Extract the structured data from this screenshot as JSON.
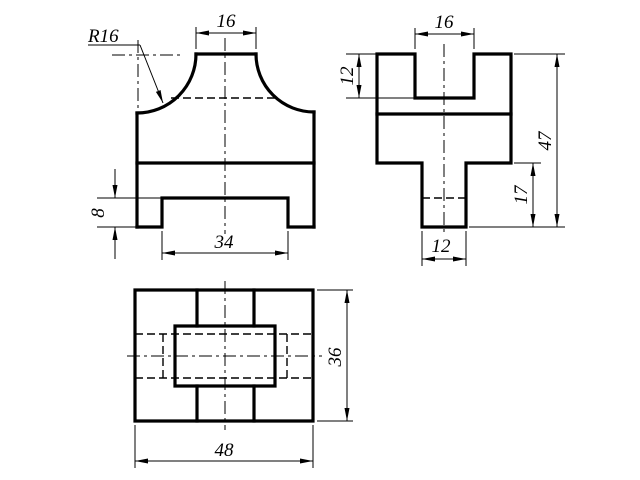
{
  "drawing": {
    "colors": {
      "line": "#000000",
      "background": "#ffffff"
    },
    "front_view": {
      "radius_label": "R16",
      "dim_top_width": "16",
      "dim_slot_height": "8",
      "dim_slot_width": "34"
    },
    "side_view": {
      "dim_notch_width": "16",
      "dim_notch_depth": "12",
      "dim_total_height": "47",
      "dim_stem_height": "17",
      "dim_stem_width": "12"
    },
    "top_view": {
      "dim_overall_width": "48",
      "dim_overall_depth": "36"
    }
  }
}
